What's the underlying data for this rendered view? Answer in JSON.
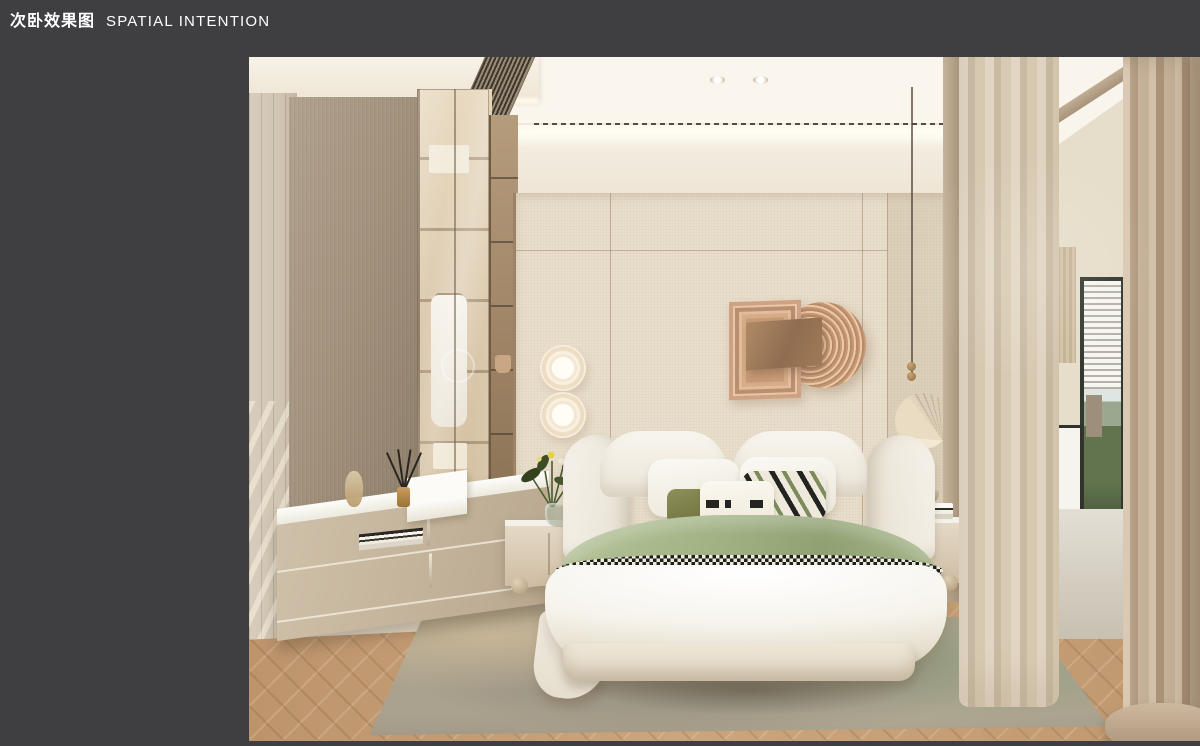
{
  "header": {
    "title_zh": "次卧效果图",
    "title_en": "SPATIAL INTENTION"
  },
  "colors": {
    "background": "#3f3f41",
    "title_text": "#ffffff",
    "ceiling_cream": "#f4eee3",
    "cove_light": "#fffdf4",
    "wall_beige": "#e8decb",
    "wardrobe_wood": "#a4937e",
    "cabinet_interior": "#d9c6a9",
    "art_copper": "#c89b7c",
    "art_bronze": "#8f6d50",
    "bedding_white": "#f6f3ec",
    "throw_green": "#9fb183",
    "houndstooth_dark": "#1f1f1b",
    "nightstand_wood": "#cfbda4",
    "floor_oak": "#c49c74",
    "rug_gray": "#8e887a",
    "rug_green": "#99a184",
    "curtain_beige": "#c4b096",
    "window_foliage": "#61744e"
  }
}
